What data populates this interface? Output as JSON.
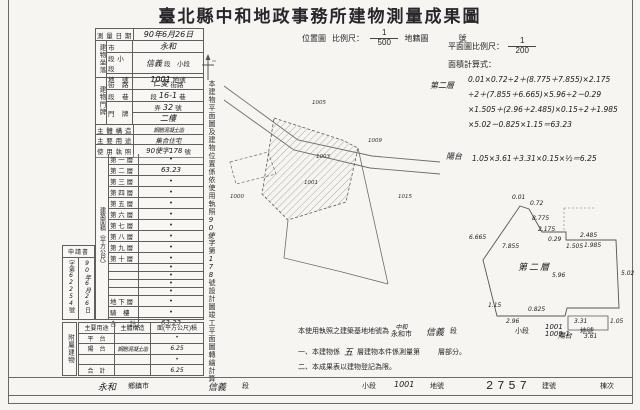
{
  "title": "臺北縣中和地政事務所建物測量成果圖",
  "form": {
    "survey_date": {
      "label": "測 量 日 期",
      "value": "90年6月26日"
    },
    "location": {
      "group": "建物坐落",
      "rows": [
        {
          "label": "市",
          "pre": "",
          "hw": "永和",
          "suffix": ""
        },
        {
          "label": "段 小 段",
          "pre": "",
          "hw": "信義",
          "suffix": "段　小段"
        },
        {
          "label": "地　號",
          "pre": "",
          "hw": "1001",
          "suffix": "地號"
        }
      ]
    },
    "address": {
      "group": "建物門牌",
      "rows": [
        {
          "label": "街　路",
          "pre": "",
          "hw": "仁愛",
          "suffix": "街路"
        },
        {
          "label": "段　巷",
          "pre": "段",
          "hw": "16-1",
          "suffix": "巷"
        },
        {
          "label": "門　牌",
          "pre": "弄",
          "hw": "32",
          "suffix": "號"
        },
        {
          "label": "",
          "pre": "",
          "hw": "二樓",
          "suffix": ""
        }
      ]
    },
    "structure": {
      "label": "主 體 構 造",
      "value": "鋼筋混凝土造"
    },
    "usage": {
      "label": "主 要 用 途",
      "value": "集合住宅"
    },
    "license": {
      "label": "使 用 執 照",
      "value": "90使字178",
      "suffix": "號"
    }
  },
  "floor_area": {
    "side_label": "建築面積（平方公尺）",
    "rows": [
      {
        "label": "第 一 層",
        "value": "•"
      },
      {
        "label": "第 二 層",
        "value": "63.23"
      },
      {
        "label": "第 三 層",
        "value": "•"
      },
      {
        "label": "第 四 層",
        "value": "•"
      },
      {
        "label": "第 五 層",
        "value": "•"
      },
      {
        "label": "第 六 層",
        "value": "•"
      },
      {
        "label": "第 七 層",
        "value": "•"
      },
      {
        "label": "第 八 層",
        "value": "•"
      },
      {
        "label": "第 九 層",
        "value": "•"
      },
      {
        "label": "第 十 層",
        "value": "•"
      },
      {
        "label": "",
        "value": "•"
      },
      {
        "label": "",
        "value": "•"
      },
      {
        "label": "",
        "value": "•"
      },
      {
        "label": "",
        "value": "•"
      },
      {
        "label": "地 下 層",
        "value": "•"
      },
      {
        "label": "騎　樓",
        "value": "•"
      },
      {
        "label": "合　　計",
        "value": "63.23"
      }
    ]
  },
  "application": {
    "header": "申請書",
    "left_label": "字第",
    "number": "62254",
    "number_suffix": "號",
    "date": "90年6月26",
    "date_suffix": "日"
  },
  "attached": {
    "side_label": "附屬建物",
    "headers": [
      "主要用途",
      "主體構造",
      "面(平方公尺)積"
    ],
    "rows": [
      {
        "use": "平　台",
        "struct": "",
        "area": "•"
      },
      {
        "use": "陽　台",
        "struct": "鋼筋混凝土造",
        "area": "6.25"
      },
      {
        "use": "",
        "struct": "",
        "area": "•"
      },
      {
        "use": "合　計",
        "struct": "",
        "area": "6.25"
      }
    ]
  },
  "vertical_caption": {
    "pre": "本建物平面圖及建物位置係依使用執照",
    "hw1": "90使",
    "mid": "字第",
    "hw2": "178",
    "post": "號設計圖竣工平面圖轉繪計算"
  },
  "location_map": {
    "label": "位置圖",
    "scale_label": "比例尺：",
    "scale_num": "1",
    "scale_den": "500",
    "ref": "地籍圖",
    "ref_suffix": "號",
    "parcels": [
      "1005",
      "1009",
      "1003",
      "1001",
      "1000",
      "1015"
    ]
  },
  "plan_panel": {
    "scale_label": "平面圖比例尺：",
    "scale_num": "1",
    "scale_den": "200",
    "calc_label": "面積計算式：",
    "f1_name": "第二層",
    "f1_text": "0.01×0.72÷2＋(8.775＋7.855)×2.175\n÷2＋(7.855＋6.665)×5.96÷2－0.29\n×1.505＋(2.96＋2.485)×0.15÷2＋1.985\n×5.02－0.825×1.15＝63.23",
    "f2_name": "陽台",
    "f2_text": "1.05×3.61＋3.31×0.15×½＝6.25"
  },
  "plan_drawing": {
    "floor_label": "第二層",
    "balcony_label": "陽台",
    "dims": [
      "0.01",
      "0.72",
      "8.775",
      "2.175",
      "0.29",
      "1.505",
      "2.485",
      "1.985",
      "7.855",
      "6.665",
      "5.96",
      "5.02",
      "1.15",
      "0.825",
      "2.96",
      "3.31",
      "1.05",
      "3.61"
    ]
  },
  "notes": {
    "line1_pre": "本使用執照之建築基地地號為",
    "line1_hw_city": "中和",
    "line1_city": "永和市",
    "line1_hw_sec": "信義",
    "line1_sec": "段",
    "line1_subsec": "小段",
    "line1_parcel1": "1001",
    "line1_parcel2": "1009-1",
    "line1_suffix": "地號",
    "line2_pre": "一、本建物係",
    "line2_hw": "五",
    "line2_mid": "層建物本件係測量第",
    "line2_suffix": "層部分。",
    "line3": "二、本成果表以建物登記為限。"
  },
  "footer": {
    "city_hw": "永和",
    "city": "鄉鎮市",
    "sec_hw": "信義",
    "sec": "段",
    "subsec": "小段",
    "parcel_hw": "1001",
    "parcel": "地號",
    "bldg_no": "2757",
    "bldg": "建號",
    "unit": "棟次"
  }
}
